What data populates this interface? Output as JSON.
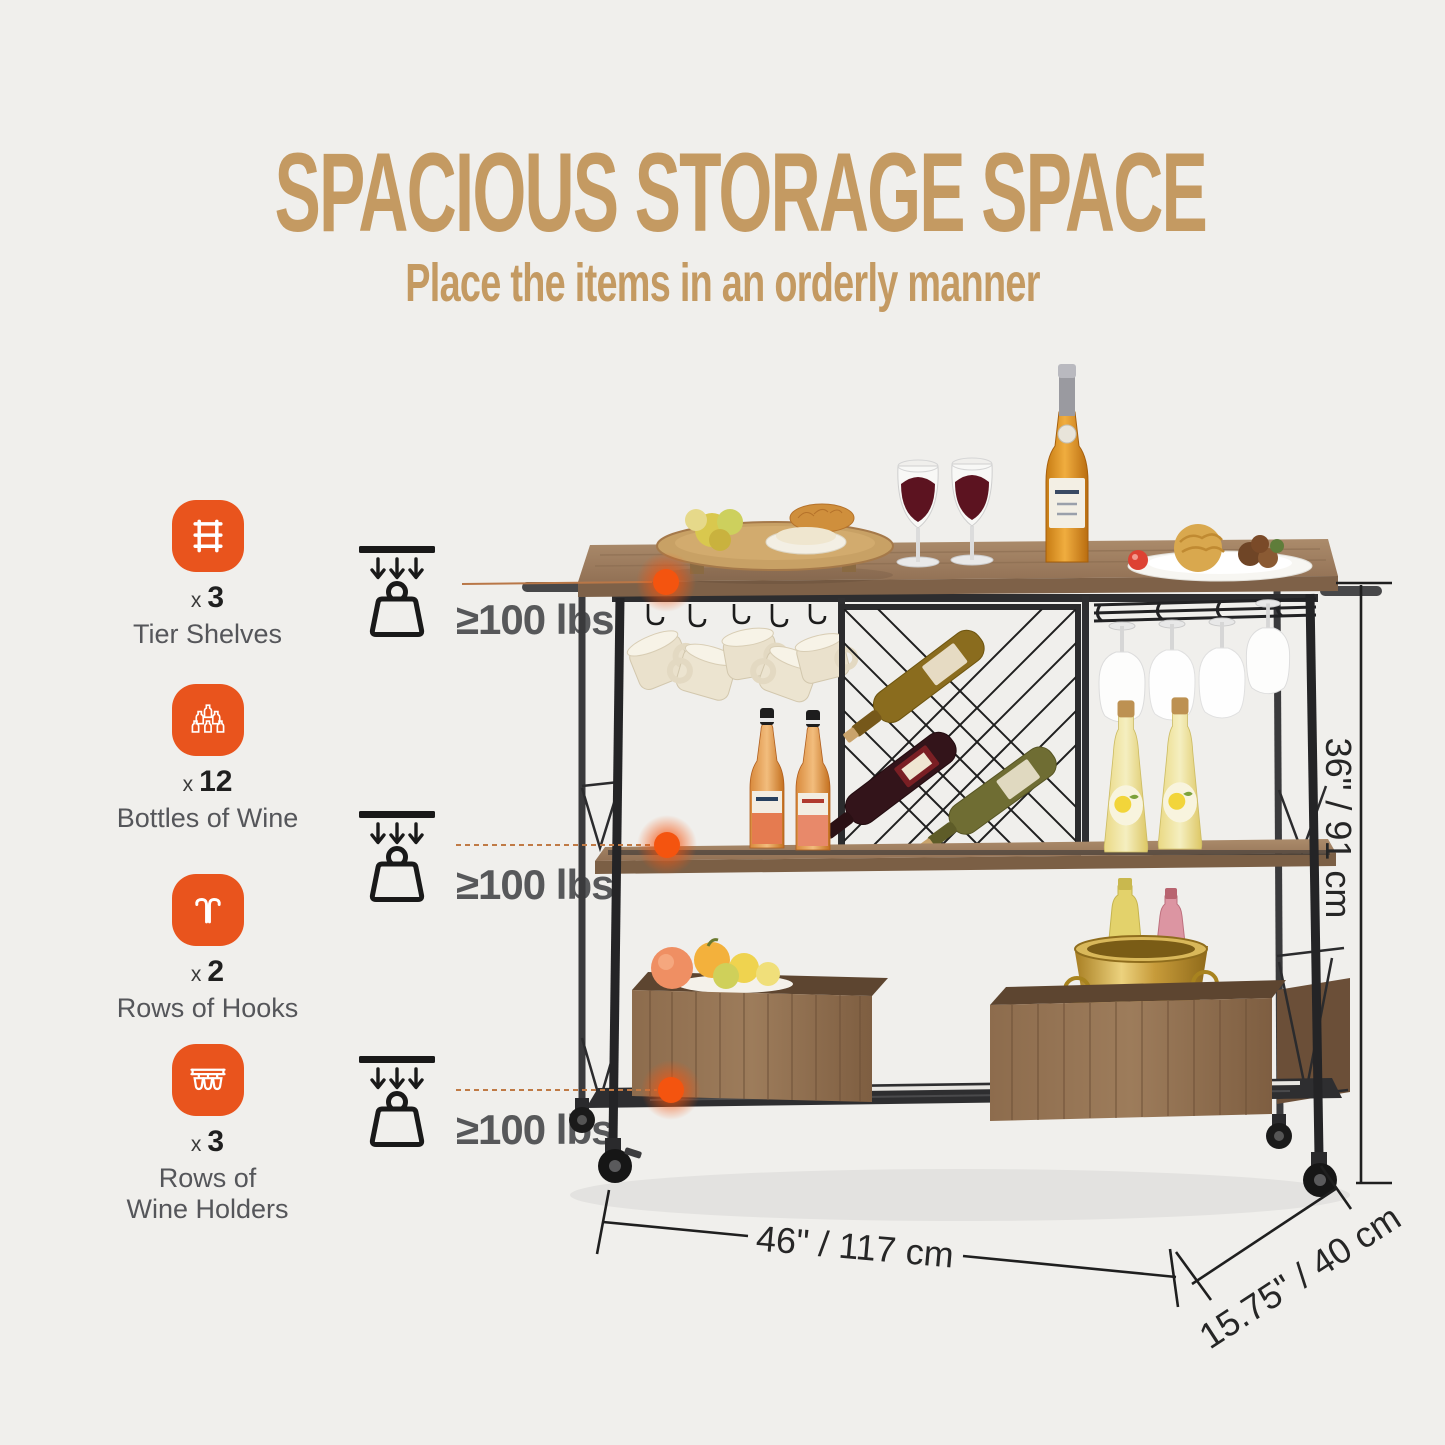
{
  "header": {
    "title": "SPACIOUS STORAGE SPACE",
    "subtitle": "Place the items in an orderly manner"
  },
  "features": [
    {
      "icon": "tier-shelves-icon",
      "x": "x",
      "count": "3",
      "label": "Tier Shelves"
    },
    {
      "icon": "wine-bottles-icon",
      "x": "x",
      "count": "12",
      "label": "Bottles of Wine"
    },
    {
      "icon": "hook-rows-icon",
      "x": "x",
      "count": "2",
      "label": "Rows of Hooks"
    },
    {
      "icon": "wine-holder-rows-icon",
      "x": "x",
      "count": "3",
      "label": "Rows of\nWine Holders"
    }
  ],
  "load_ratings": [
    {
      "icon": "weight-load-icon",
      "label": "≥100 lbs",
      "points_to": "top-shelf"
    },
    {
      "icon": "weight-load-icon",
      "label": "≥100 lbs",
      "points_to": "middle-shelf"
    },
    {
      "icon": "weight-load-icon",
      "label": "≥100 lbs",
      "points_to": "bottom-shelf"
    }
  ],
  "dimensions": {
    "width": "46\" / 117 cm",
    "depth": "15.75\" / 40 cm",
    "height": "36\" / 91 cm"
  },
  "colors": {
    "background": "#f0efec",
    "title_tan": "#c49a62",
    "accent_orange": "#e9541d",
    "load_text_gray": "#57585a",
    "feature_label_gray": "#55565a",
    "dimension_line": "#1f1f1f",
    "leader_line_orange": "#c07a45",
    "frame_black": "#2d2d2f",
    "wood_brown": "#9b7c5e",
    "gold_bucket": "#c79b3a"
  }
}
